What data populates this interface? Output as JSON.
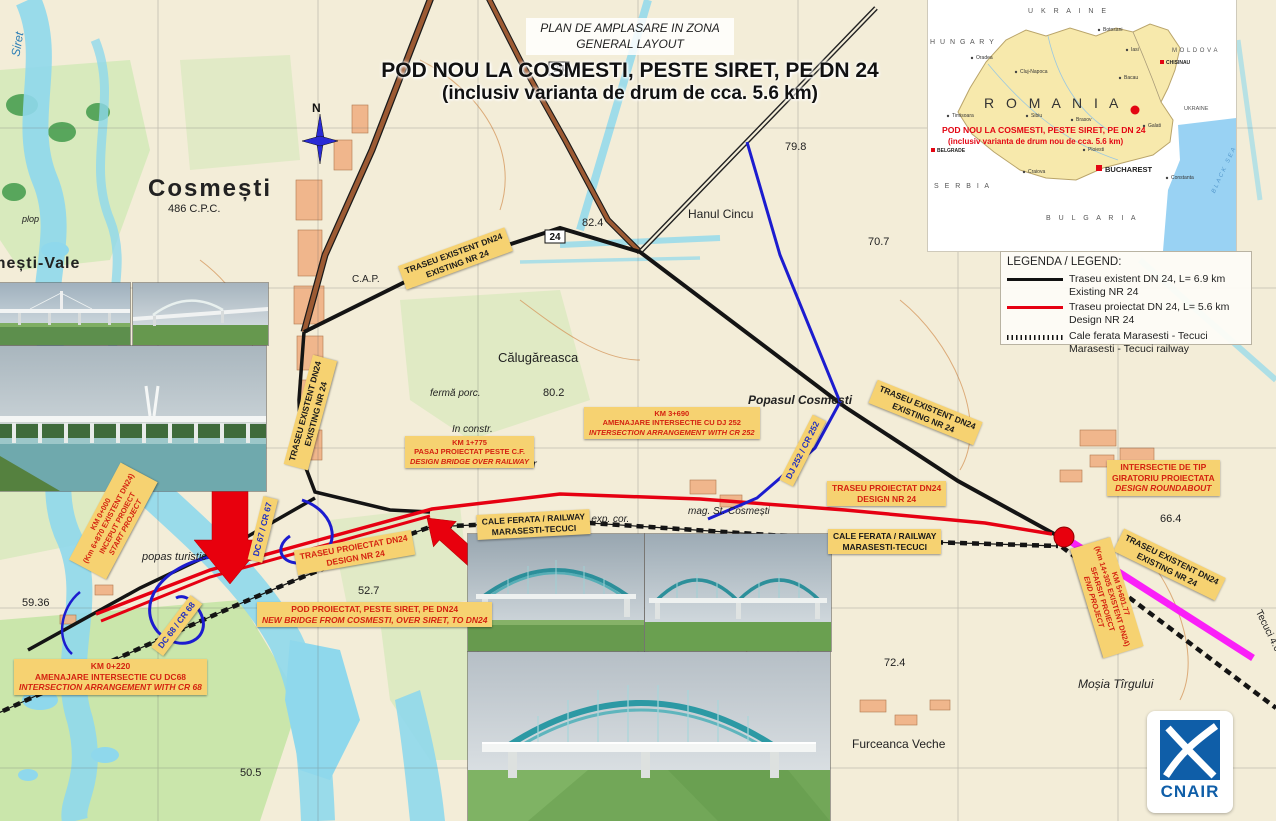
{
  "title_block": {
    "line1": "PLAN DE AMPLASARE IN ZONA",
    "line2": "GENERAL LAYOUT",
    "line3": "POD NOU LA COSMESTI, PESTE SIRET, PE DN 24",
    "line4": "(inclusiv varianta de drum de cca. 5.6 km)"
  },
  "compass": {
    "north": "N"
  },
  "inset": {
    "caption1": "POD NOU LA COSMESTI, PESTE SIRET,  PE DN 24",
    "caption2": "(inclusiv varianta de drum nou de cca. 5.6 km)",
    "country": "R O M A N I A",
    "neighbors": {
      "ukraine_north": "U K R A I N E",
      "hungary": "H U N G A R Y",
      "moldova": "M O L D O V A",
      "ukraine_east": "UKRAINE",
      "serbia": "S E R B I A",
      "bulgaria": "B U L G A R I A",
      "black_sea": "BLACK SEA"
    },
    "cities": {
      "bucharest": "BUCHAREST",
      "chisinau": "CHISINAU",
      "belgrade": "BELGRADE",
      "botosani": "Botosani",
      "iasi": "Iasi",
      "bacau": "Bacau",
      "cluj": "Cluj-Napoca",
      "oradea": "Oradea",
      "timisoara": "Timisoara",
      "sibiu": "Sibiu",
      "brasov": "Brasov",
      "galati": "Galati",
      "craiova": "Craiova",
      "ploiesti": "Ploiesti",
      "constanta": "Constanta"
    }
  },
  "legend": {
    "title": "LEGENDA / LEGEND:",
    "item1_l1": "Traseu existent DN 24, L= 6.9 km",
    "item1_l2": "Existing NR 24",
    "item2_l1": "Traseu proiectat DN 24, L= 5.6 km",
    "item2_l2": "Design NR 24",
    "item3_l1": "Cale ferata Marasesti - Tecuci",
    "item3_l2": "Marasesti - Tecuci railway"
  },
  "callouts": {
    "existing_top": {
      "l1": "TRASEU EXISTENT DN24",
      "l2": "EXISTING NR 24"
    },
    "existing_left": {
      "l1": "TRASEU EXISTENT DN24",
      "l2": "EXISTING NR 24"
    },
    "existing_right": {
      "l1": "TRASEU EXISTENT DN24",
      "l2": "EXISTING NR 24"
    },
    "existing_far_right": {
      "l1": "TRASEU EXISTENT DN24",
      "l2": "EXISTING NR 24"
    },
    "design_left": {
      "l1": "TRASEU PROIECTAT DN24",
      "l2": "DESIGN NR 24"
    },
    "design_right": {
      "l1": "TRASEU PROIECTAT DN24",
      "l2": "DESIGN NR 24"
    },
    "railway_left": {
      "l1": "CALE FERATA / RAILWAY",
      "l2": "MARASESTI-TECUCI"
    },
    "railway_right": {
      "l1": "CALE FERATA / RAILWAY",
      "l2": "MARASESTI-TECUCI"
    },
    "km1775": {
      "l1": "KM 1+775",
      "l2": "PASAJ PROIECTAT PESTE C.F.",
      "l3": "DESIGN BRIDGE OVER RAILWAY"
    },
    "km3690": {
      "l1": "KM 3+690",
      "l2": "AMENAJARE INTERSECTIE CU DJ 252",
      "l3": "INTERSECTION ARRANGEMENT WITH CR 252"
    },
    "giratoriu": {
      "l1": "INTERSECTIE DE TIP",
      "l2": "GIRATORIU PROIECTATA",
      "l3": "DESIGN ROUNDABOUT"
    },
    "pod": {
      "l1": "POD PROIECTAT, PESTE SIRET, PE DN24",
      "l2": "NEW BRIDGE FROM COSMESTI, OVER SIRET, TO DN24"
    },
    "km0220": {
      "l1": "KM 0+220",
      "l2": "AMENAJARE INTERSECTIE CU DC68",
      "l3": "INTERSECTION ARRANGEMENT WITH CR 68"
    },
    "km0000": {
      "l1": "KM 0+000",
      "l2": "(Km 6+870 EXISTENT DN24)",
      "l3": "INCEPUT PROIECT",
      "l4": "START PROJECT"
    },
    "km_end": {
      "l1": "KM 5+601.77",
      "l2": "(Km 14+305 EXISTENT DN24)",
      "l3": "SFARSIT PROIECT",
      "l4": "END PROJECT"
    },
    "dc67": {
      "l1": "DC 67 / CR 67"
    },
    "dc68": {
      "l1": "DC 68 / CR 68"
    },
    "dj252": {
      "l1": "DJ 252 / CR 252"
    }
  },
  "map": {
    "cosmesti": "Cosmești",
    "cosmesti_elev": "486 C.P.C.",
    "cosmesti_vale": "Cosmești-Vale",
    "calugareasca": "Călugăreasca",
    "hanul_cincu": "Hanul Cincu",
    "popasul": "Popasul Cosmești",
    "baltareti": "Bălțăreți",
    "baltareti_elev": "324",
    "furceanca": "Furceanca Veche",
    "mosia": "Moșia Tîrgului",
    "st_cosmesti": "mag. St. Cosmești",
    "popas_turistic": "popas turistic",
    "ferma": "fermă porc.",
    "in_constr": "In constr.",
    "decantor": "decantor",
    "st_exp": "st. exp. cor.",
    "siret": "Siret",
    "plop": "plop",
    "cap": "C.A.P.",
    "tecuci": "Tecuci 4.0 km",
    "road24": "24",
    "elev1": "79.8",
    "elev2": "70.7",
    "elev3": "82.4",
    "elev4": "80.2",
    "elev5": "59.36",
    "elev6": "52.7",
    "elev7": "50.5",
    "elev8": "72.4",
    "elev9": "66.4"
  },
  "branding": {
    "cnair": "CNAIR"
  },
  "colors": {
    "existing_route": "#141414",
    "design_route": "#e60012",
    "end_segment": "#fa14fa",
    "secondary_roads": "#1c1ccf",
    "roundabout_dot": "#e8000d",
    "callout_bg": "#f6d271",
    "callout_text_red": "#d42310",
    "cnair_blue": "#0f5ea8"
  }
}
